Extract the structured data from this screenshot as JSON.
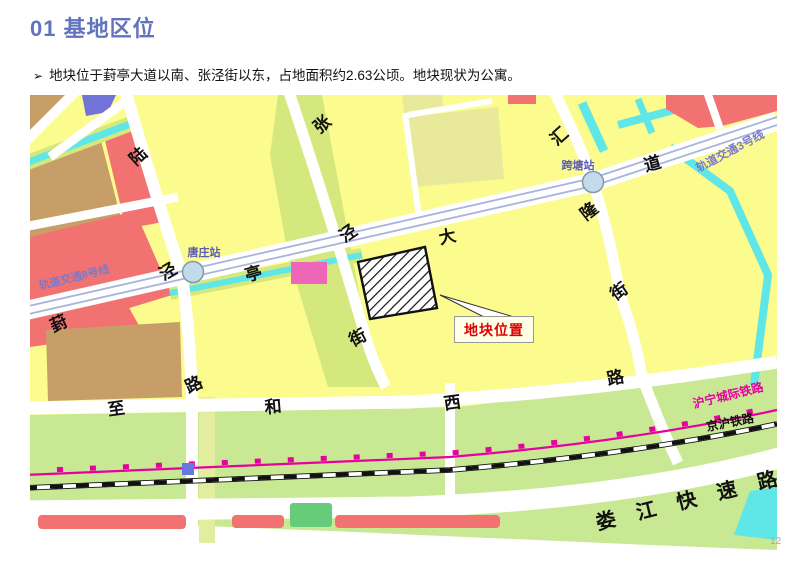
{
  "page": {
    "title": "01 基地区位",
    "bullet_marker": "➢",
    "bullet": "地块位于葑亭大道以南、张泾街以东，占地面积约2.63公顷。地块现状为公寓。",
    "page_number": "12"
  },
  "map": {
    "stations": [
      {
        "name": "唐庄站"
      },
      {
        "name": "跨塘站"
      }
    ],
    "metro_lines": [
      {
        "name": "轨道交通8号线"
      },
      {
        "name": "轨道交通3号线"
      }
    ],
    "streets": {
      "fengting_dadao": [
        "葑",
        "亭",
        "大",
        "道"
      ],
      "lujing_lu": [
        "陆",
        "泾",
        "路"
      ],
      "zhangjing_jie": [
        "张",
        "泾",
        "街"
      ],
      "huilong_jie": [
        "汇",
        "隆",
        "街"
      ],
      "zhihe_xilu": [
        "至",
        "和",
        "西",
        "路"
      ],
      "loujiang_expressway": "娄 江 快 速 路"
    },
    "railways": [
      {
        "name": "沪宁城际铁路"
      },
      {
        "name": "京沪铁路"
      }
    ],
    "callout": {
      "label": "地块位置"
    },
    "colors": {
      "title_blue": "#6273BE",
      "block_yellow": "#FBFB8E",
      "block_khaki": "#E9E99C",
      "block_yellowgreen": "#D5E87D",
      "block_lightgreen": "#C8E894",
      "block_green": "#66CC7A",
      "block_tan": "#C89E68",
      "block_red": "#F27272",
      "block_pink": "#EE66B8",
      "block_purple": "#7273D8",
      "water_cyan": "#5FE6E6",
      "metro_line": "#A9B4DC",
      "station_fill": "#C2DAEA",
      "rail_magenta": "#E6009E",
      "callout_red": "#DD0000"
    }
  }
}
